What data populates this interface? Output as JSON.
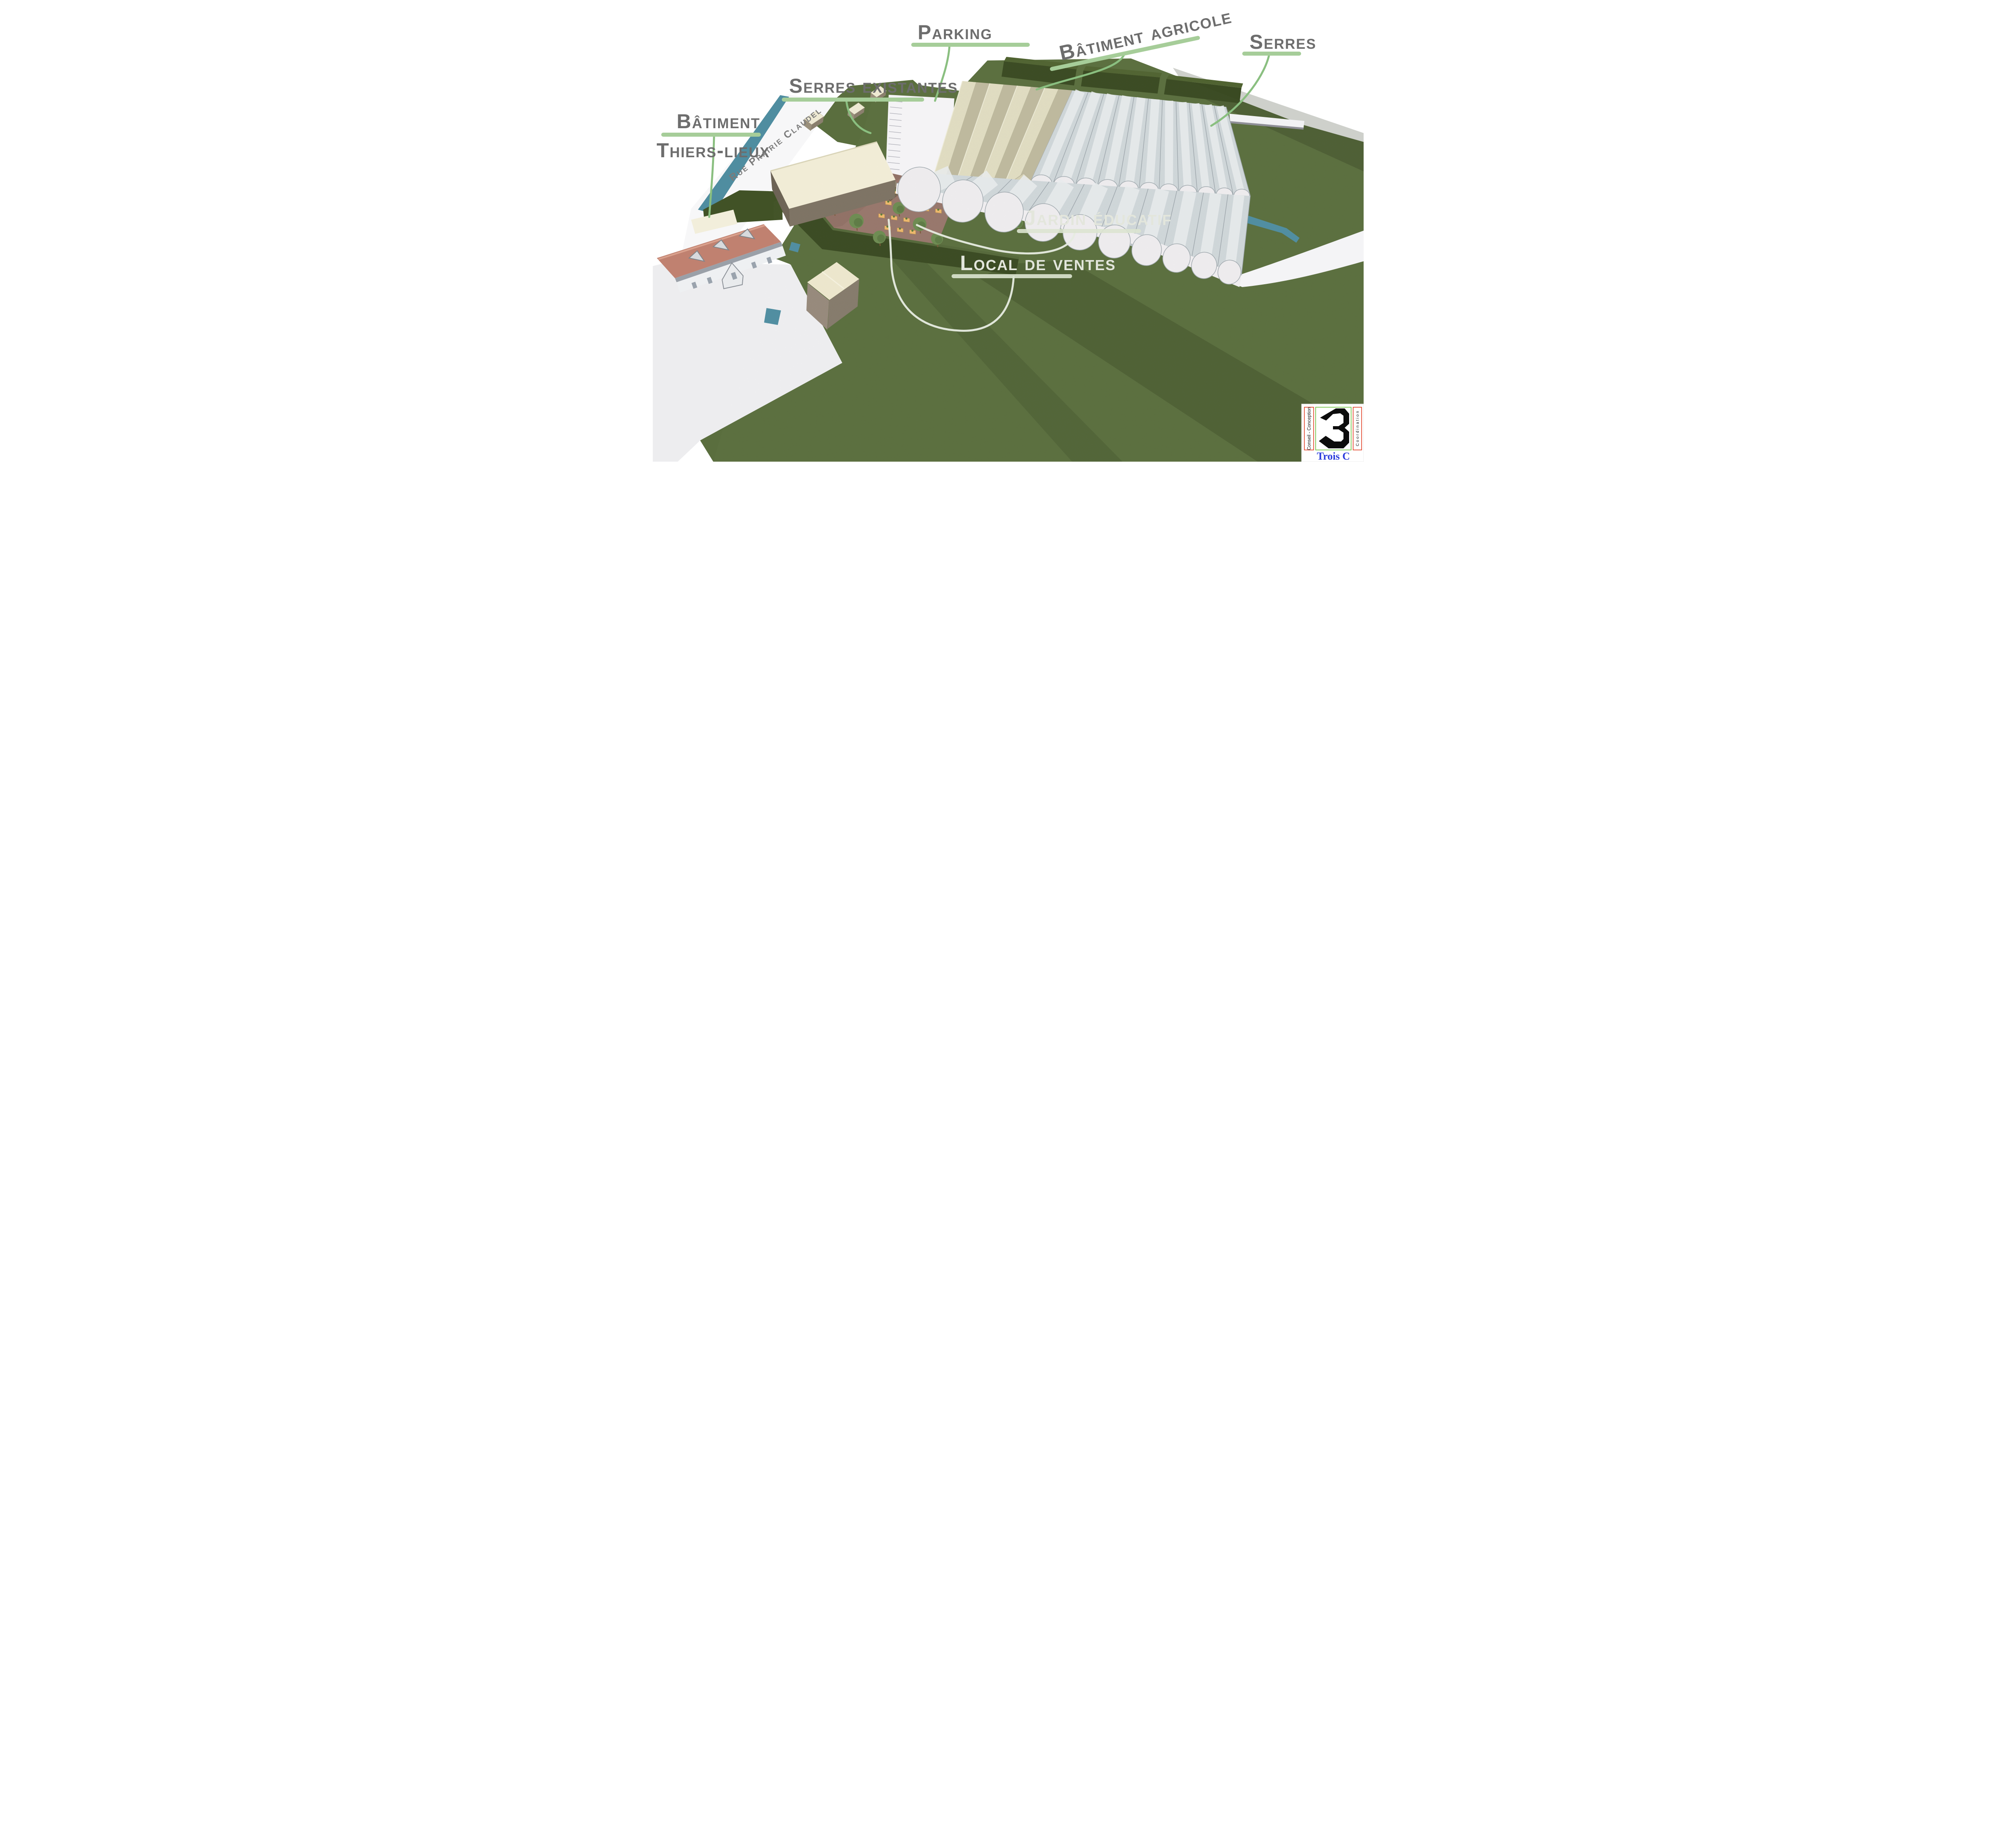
{
  "labels": {
    "parking": {
      "text": "Parking"
    },
    "batiment_agricole": {
      "text": "Bâtiment agricole"
    },
    "serres": {
      "text": "Serres"
    },
    "serres_existantes": {
      "text": "Serres existantes"
    },
    "batiment_thiers_lieux": {
      "line1": "Bâtiment",
      "line2": "Thiers-lieux"
    },
    "rue_prairie_claudel": {
      "text": "Rue Prairie Claudel"
    },
    "jardin_educatif": {
      "text": "Jardin éducatif"
    },
    "local_de_ventes": {
      "text": "Local de ventes"
    }
  },
  "logo": {
    "left_text": "Conseil - Conception",
    "right_text": "C o o r d i n a t i o n",
    "numeral": "3",
    "brand": "Trois C"
  },
  "colors": {
    "underline_green": "#a6cd99",
    "leader_green": "#8abf80",
    "label_gray": "#6d6d6d",
    "label_white": "#e3e6dc",
    "stream_teal": "#4f8da0",
    "grass": "#5a6e3e",
    "grass_shadow": "#3f4f28",
    "hedge": "#3a4a22",
    "soil": "#97766b",
    "planter_orange": "#ecb76b",
    "roof_salmon": "#c08170",
    "cream": "#efe9d2",
    "vault_gray": "#ced5d8",
    "logo_red": "#e0391d",
    "logo_green": "#6abf3a",
    "logo_blue": "#2a3bdc"
  },
  "scene": {
    "front_vault_count": 10,
    "back_vault_count": 11,
    "parking_stall_count": 12,
    "planters": [
      [
        612,
        446
      ],
      [
        643,
        450
      ],
      [
        674,
        455
      ],
      [
        594,
        470
      ],
      [
        625,
        475
      ],
      [
        656,
        480
      ],
      [
        687,
        485
      ],
      [
        718,
        490
      ],
      [
        577,
        498
      ],
      [
        608,
        503
      ],
      [
        639,
        508
      ],
      [
        670,
        513
      ],
      [
        701,
        518
      ],
      [
        732,
        523
      ],
      [
        560,
        530
      ],
      [
        591,
        535
      ],
      [
        622,
        540
      ],
      [
        653,
        545
      ],
      [
        575,
        560
      ],
      [
        606,
        565
      ],
      [
        637,
        570
      ]
    ],
    "trees": [
      [
        352,
        428,
        15
      ],
      [
        420,
        408,
        13
      ],
      [
        402,
        472,
        16
      ],
      [
        450,
        512,
        17
      ],
      [
        505,
        548,
        18
      ],
      [
        562,
        588,
        16
      ],
      [
        610,
        516,
        15
      ],
      [
        662,
        556,
        17
      ],
      [
        705,
        592,
        15
      ],
      [
        548,
        468,
        14
      ],
      [
        470,
        452,
        12
      ],
      [
        905,
        553,
        13
      ]
    ],
    "huts": [
      [
        400,
        295,
        1.0
      ],
      [
        505,
        272,
        0.85
      ],
      [
        560,
        230,
        0.8
      ]
    ]
  }
}
